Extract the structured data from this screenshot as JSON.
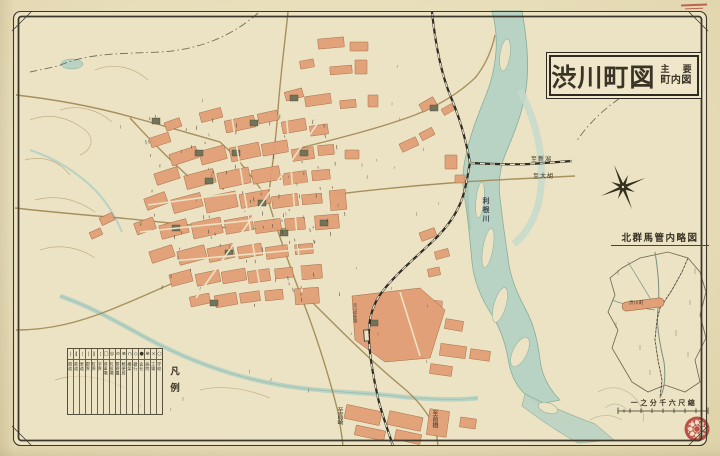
{
  "title_box": {
    "main": "渋川町図",
    "sub_line1": "主 要",
    "sub_line2": "町内図"
  },
  "inset": {
    "title": "北群馬管内略図",
    "highlight_label": "渋川町"
  },
  "scale_label": "一之分千六尺縮",
  "legend": {
    "title": "凡例",
    "items": [
      {
        "symbol": "|",
        "label": "国道"
      },
      {
        "symbol": "‖",
        "label": "県道"
      },
      {
        "symbol": "¦",
        "label": "里道"
      },
      {
        "symbol": "|",
        "label": "郡界"
      },
      {
        "symbol": "‖",
        "label": "町界"
      },
      {
        "symbol": "¦",
        "label": "字界"
      },
      {
        "symbol": "□",
        "label": "停車場"
      },
      {
        "symbol": "◎",
        "label": "町役場"
      },
      {
        "symbol": "⊙",
        "label": "警察署"
      },
      {
        "symbol": "⊗",
        "label": "郵便局"
      },
      {
        "symbol": "∩",
        "label": "橋梁"
      },
      {
        "symbol": "◇",
        "label": "銀行"
      },
      {
        "symbol": "●",
        "label": "会社"
      },
      {
        "symbol": "⊕",
        "label": "病院"
      },
      {
        "symbol": "×",
        "label": "工場"
      },
      {
        "symbol": "○",
        "label": "学校"
      }
    ]
  },
  "labels": {
    "river": "利根川",
    "to_niigata": "至新潟",
    "to_ogo": "至大胡",
    "to_takasaki": "至高崎",
    "to_maebashi": "至前橋",
    "station": "渋川停車場"
  },
  "colors": {
    "paper": "#ebe2c1",
    "river": "#b8d2c3",
    "town_block": "#e2a078",
    "ink": "#3a3426",
    "seal_red": "#b8423a"
  }
}
